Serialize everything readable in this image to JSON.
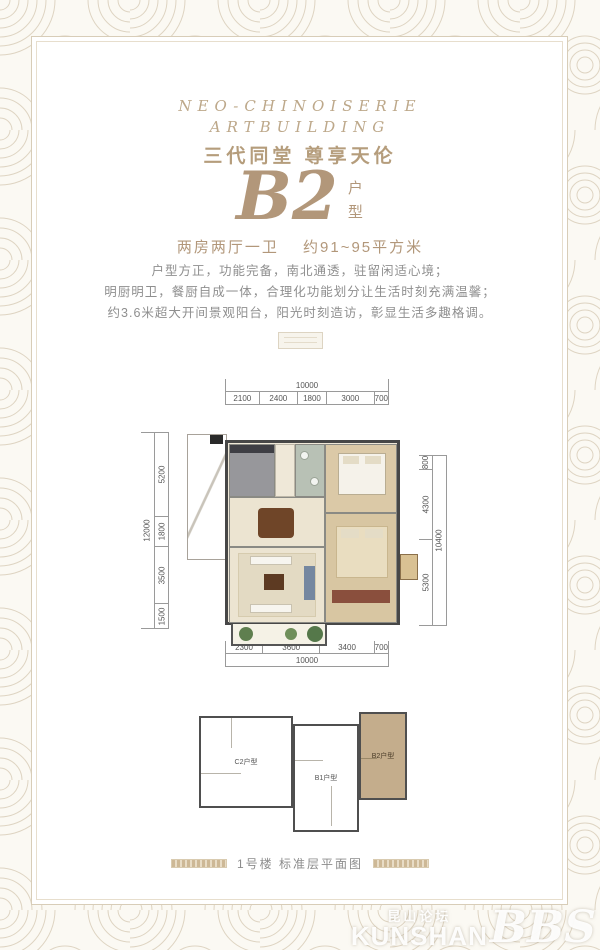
{
  "header": {
    "line1": "NEO-CHINOISERIE",
    "line2": "ARTBUILDING",
    "tagline": "三代同堂  尊享天伦"
  },
  "unit": {
    "name": "B2",
    "type_top": "户",
    "type_bottom": "型",
    "spec": "两房两厅一卫",
    "area": "约91~95平方米"
  },
  "description": {
    "lines": [
      "户型方正，功能完备，南北通透，驻留闲适心境；",
      "明厨明卫，餐厨自成一体，合理化功能划分让生活时刻充满温馨；",
      "约3.6米超大开间景观阳台，阳光时刻造访，彰显生活多趣格调。"
    ]
  },
  "floorplan": {
    "dims_top": {
      "total": "10000",
      "segments": [
        "2100",
        "2400",
        "1800",
        "3000",
        "700"
      ]
    },
    "dims_bottom": {
      "total": "10000",
      "segments": [
        "2300",
        "3600",
        "3400",
        "700"
      ]
    },
    "dims_left": {
      "total": "12000",
      "segments": [
        "5200",
        "1800",
        "3500",
        "1500"
      ]
    },
    "dims_right": {
      "total": "10400",
      "segments": [
        "800",
        "4300",
        "5300"
      ]
    }
  },
  "keyplan": {
    "units": [
      {
        "label": "C2户型",
        "highlighted": false
      },
      {
        "label": "B1户型",
        "highlighted": false
      },
      {
        "label": "B2户型",
        "highlighted": true
      }
    ]
  },
  "caption": {
    "text": "1号楼 标准层平面图"
  },
  "watermark": {
    "cn": "昆山论坛",
    "en": "KUNSHAN",
    "bbs": "BBS"
  },
  "colors": {
    "accent_gold": "#b2977a",
    "header_gold": "#bda88a",
    "text_gray": "#8f8f8f",
    "dimension_gray": "#555555",
    "wall_dark": "#474747",
    "highlight_unit_tan": "#c4ad8c",
    "pattern_line": "#ded4c2"
  }
}
